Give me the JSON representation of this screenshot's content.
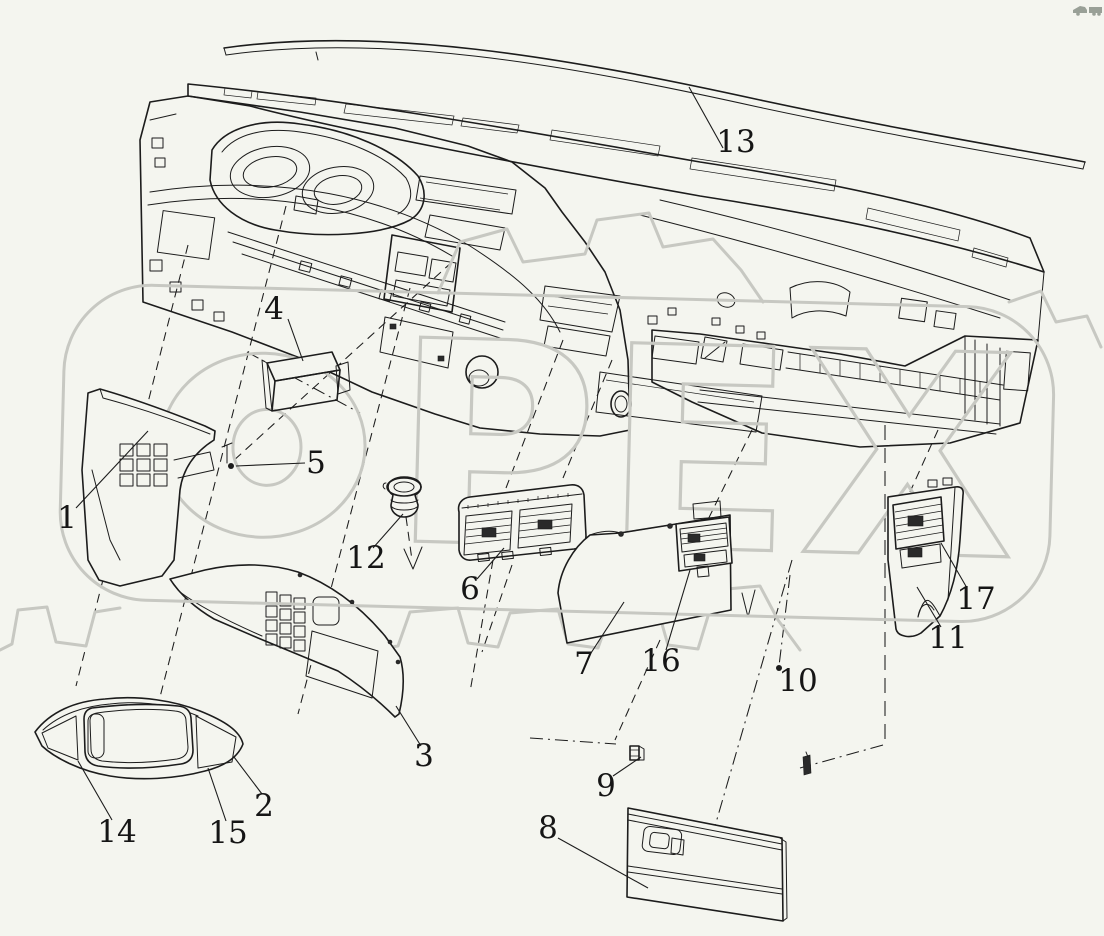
{
  "figure": {
    "type": "exploded-parts-diagram",
    "subject": "truck-dashboard-instrument-panel",
    "background_color": "#f4f5ef",
    "line_color": "#1c1c1c",
    "watermark": {
      "word": "ОРЕХ",
      "letters_after_o": "РЕХ",
      "color": "#c7c8c2"
    },
    "corner_icon": "truck-icon"
  },
  "callouts": [
    {
      "num": "1",
      "x": 67,
      "y": 517,
      "leader": [
        [
          76,
          508
        ],
        [
          148,
          431
        ]
      ]
    },
    {
      "num": "2",
      "x": 264,
      "y": 805,
      "leader": [
        [
          262,
          794
        ],
        [
          234,
          757
        ]
      ]
    },
    {
      "num": "3",
      "x": 424,
      "y": 755,
      "leader": [
        [
          421,
          746
        ],
        [
          396,
          706
        ]
      ]
    },
    {
      "num": "4",
      "x": 274,
      "y": 308,
      "leader": [
        [
          288,
          319
        ],
        [
          303,
          361
        ]
      ]
    },
    {
      "num": "5",
      "x": 316,
      "y": 462,
      "leader": [
        [
          305,
          463
        ],
        [
          236,
          466
        ]
      ],
      "dot": [
        231,
        466
      ]
    },
    {
      "num": "6",
      "x": 470,
      "y": 588,
      "leader": [
        [
          477,
          579
        ],
        [
          504,
          548
        ]
      ]
    },
    {
      "num": "7",
      "x": 584,
      "y": 663,
      "leader": [
        [
          591,
          653
        ],
        [
          624,
          602
        ]
      ]
    },
    {
      "num": "8",
      "x": 548,
      "y": 827,
      "leader": [
        [
          558,
          838
        ],
        [
          648,
          888
        ]
      ]
    },
    {
      "num": "9",
      "x": 606,
      "y": 785,
      "leader": [
        [
          613,
          776
        ],
        [
          641,
          757
        ]
      ]
    },
    {
      "num": "10",
      "x": 798,
      "y": 680,
      "dot": [
        779,
        668
      ]
    },
    {
      "num": "11",
      "x": 948,
      "y": 637,
      "leader": [
        [
          941,
          627
        ],
        [
          917,
          587
        ]
      ]
    },
    {
      "num": "12",
      "x": 366,
      "y": 557,
      "leader": [
        [
          373,
          548
        ],
        [
          403,
          514
        ]
      ]
    },
    {
      "num": "13",
      "x": 736,
      "y": 141,
      "leader": [
        [
          723,
          148
        ],
        [
          689,
          87
        ]
      ]
    },
    {
      "num": "14",
      "x": 117,
      "y": 831,
      "leader": [
        [
          112,
          820
        ],
        [
          78,
          761
        ]
      ]
    },
    {
      "num": "15",
      "x": 228,
      "y": 832,
      "leader": [
        [
          226,
          821
        ],
        [
          208,
          768
        ]
      ]
    },
    {
      "num": "16",
      "x": 661,
      "y": 660,
      "leader": [
        [
          666,
          650
        ],
        [
          690,
          570
        ]
      ]
    },
    {
      "num": "17",
      "x": 976,
      "y": 598,
      "leader": [
        [
          967,
          588
        ],
        [
          941,
          543
        ]
      ]
    }
  ]
}
